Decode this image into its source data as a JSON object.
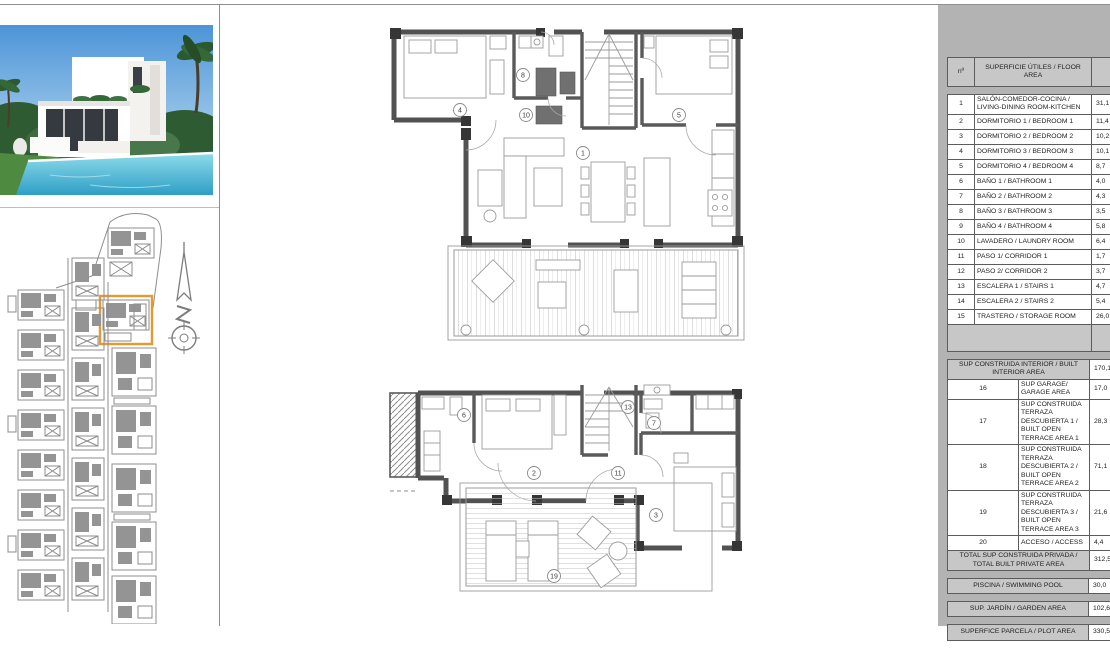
{
  "floor_plans": {
    "upper": {
      "labels": {
        "living": "1",
        "bedroom4": "4",
        "bedroom5": "5",
        "bath8": "8",
        "laundry10": "10"
      }
    },
    "lower": {
      "labels": {
        "bedroom2": "2",
        "bedroom3": "3",
        "bath6": "6",
        "bath7": "7",
        "corridor11": "11",
        "stairs13": "13",
        "terrace19": "19"
      }
    }
  },
  "area_table": {
    "header": {
      "num": "nº",
      "area": "SUPERFICIE ÚTILES / FLOOR AREA",
      "tipo": "TIPO"
    },
    "rows": [
      {
        "num": "1",
        "label": "SALÓN-COMEDOR-COCINA / LIVING-DINING ROOM-KITCHEN",
        "value": "31,1"
      },
      {
        "num": "2",
        "label": "DORMITORIO 1 / BEDROOM 1",
        "value": "11,4"
      },
      {
        "num": "3",
        "label": "DORMITORIO 2 / BEDROOM 2",
        "value": "10,2"
      },
      {
        "num": "4",
        "label": "DORMITORIO 3 / BEDROOM 3",
        "value": "10,1"
      },
      {
        "num": "5",
        "label": "DORMITORIO 4 / BEDROOM 4",
        "value": "8,7"
      },
      {
        "num": "6",
        "label": "BAÑO 1 / BATHROOM 1",
        "value": "4,0"
      },
      {
        "num": "7",
        "label": "BAÑO 2 / BATHROOM 2",
        "value": "4,3"
      },
      {
        "num": "8",
        "label": "BAÑO 3 / BATHROOM 3",
        "value": "3,5"
      },
      {
        "num": "9",
        "label": "BAÑO 4 / BATHROOM 4",
        "value": "5,8"
      },
      {
        "num": "10",
        "label": "LAVADERO / LAUNDRY ROOM",
        "value": "6,4"
      },
      {
        "num": "11",
        "label": "PASO 1/ CORRIDOR 1",
        "value": "1,7"
      },
      {
        "num": "12",
        "label": "PASO 2/ CORRIDOR 2",
        "value": "3,7"
      },
      {
        "num": "13",
        "label": "ESCALERA 1 / STAIRS 1",
        "value": "4,7"
      },
      {
        "num": "14",
        "label": "ESCALERA 2 / STAIRS 2",
        "value": "5,4"
      },
      {
        "num": "15",
        "label": "TRASTERO / STORAGE ROOM",
        "value": "26,0"
      }
    ],
    "interior_total": {
      "label": "SUP CONSTRUIDA INTERIOR / BUILT INTERIOR AREA",
      "value": "170,1"
    },
    "rows2": [
      {
        "num": "16",
        "label": "SUP GARAGE/ GARAGE AREA",
        "value": "17,0"
      },
      {
        "num": "17",
        "label": "SUP CONSTRUIDA TERRAZA DESCUBIERTA 1 / BUILT OPEN TERRACE AREA 1",
        "value": "28,3"
      },
      {
        "num": "18",
        "label": "SUP CONSTRUIDA TERRAZA DESCUBIERTA 2 / BUILT OPEN TERRACE AREA 2",
        "value": "71,1"
      },
      {
        "num": "19",
        "label": "SUP CONSTRUIDA TERRAZA DESCUBIERTA 3 / BUILT OPEN TERRACE AREA 3",
        "value": "21,6"
      },
      {
        "num": "20",
        "label": "ACCESO / ACCESS",
        "value": "4,4"
      }
    ],
    "private_total": {
      "label": "TOTAL SUP CONSTRUIDA PRIVADA / TOTAL BUILT PRIVATE AREA",
      "value": "312,5"
    },
    "summary": [
      {
        "label": "PISCINA / SWIMMING POOL",
        "value": "30,0"
      },
      {
        "label": "SUP. JARDÍN / GARDEN AREA",
        "value": "102,6"
      },
      {
        "label": "SUPERFICE PARCELA / PLOT AREA",
        "value": "330,5"
      }
    ]
  },
  "site_plan": {
    "highlight_color": "#E59A2F"
  }
}
